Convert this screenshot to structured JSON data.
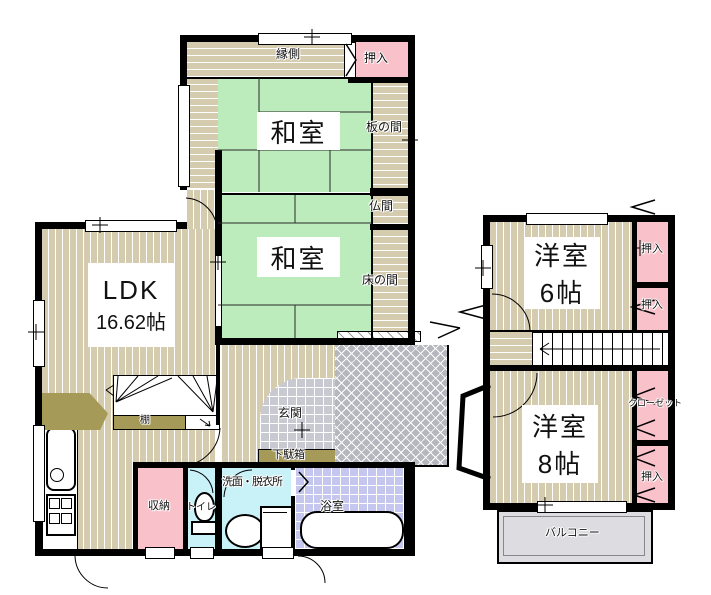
{
  "floor1": {
    "engawa_label": "縁側",
    "oshiire_top_label": "押入",
    "washitsu1_label": "和室",
    "itanoma_label": "板の間",
    "butsuma_label": "仏間",
    "washitsu2_label": "和室",
    "tokonoma_label": "床の間",
    "ldk_label": "LDK",
    "ldk_size": "16.62帖",
    "tana_label": "棚",
    "genkan_label": "玄関",
    "getabako_label": "下駄箱",
    "shuno_label": "収納",
    "toilet_label": "トイレ",
    "senmen_label": "洗面・脱衣所",
    "bath_label": "浴室"
  },
  "floor2": {
    "room6_label": "洋室",
    "room6_size": "6帖",
    "oshiire_a_label": "押入",
    "oshiire_b_label": "押入",
    "room8_label": "洋室",
    "room8_size": "8帖",
    "closet_label": "クローゼット",
    "oshiire_c_label": "押入",
    "balcony_label": "バルコニー"
  },
  "colors": {
    "wood_floor": "#d5cbae",
    "tatami_green": "#bcebbc",
    "closet_pink": "#f9c2cb",
    "water_blue": "#c9f1f8",
    "bath_tile": "#c5c7ee",
    "genkan_tile": "#c9c9d2",
    "porch_gray": "#b6b6be",
    "balcony_gray": "#dcdce1",
    "cabinet_olive": "#a69a58",
    "wall": "#000000"
  }
}
